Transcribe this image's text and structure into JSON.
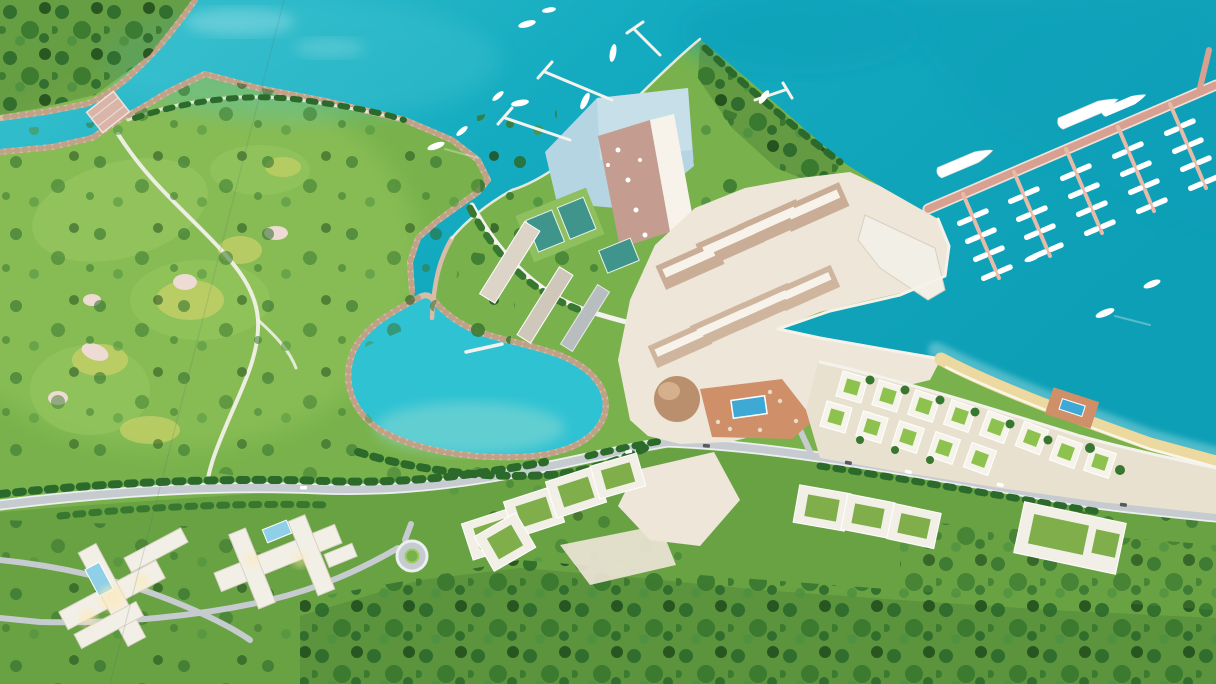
{
  "meta": {
    "title": "Aerial 3D master-plan rendering of a coastal golf and marina resort",
    "view": "bird's-eye aerial render, no text or UI elements visible"
  },
  "palette": {
    "sea_base": "#17b1c5",
    "sea_deep": "#0a9fb8",
    "sea_light": "#49c7d3",
    "sea_pale": "#cdeff0",
    "lagoon": "#2fc2d3",
    "lagoon_shallow": "#93dbd2",
    "grass": "#79b24c",
    "lawn": "#69a243",
    "grass_light": "#93c45c",
    "golf_yellow": "#c2cf66",
    "bunker": "#eedbd3",
    "forest_base": "#54893a",
    "tree_dark": "#2c6a2c",
    "tree_mid": "#38772f",
    "tree_deep": "#224f1e",
    "tree_light": "#4f9140",
    "rock": "#d7bda8",
    "rock_dark": "#b69478",
    "sand": "#ecd9a0",
    "road": "#c6cbd0",
    "road_edge": "#eceff0",
    "path_white": "#f4f2ec",
    "plaza": "#eee6d8",
    "tan_wall": "#c9ad96",
    "tan_wall2": "#cfb59e",
    "roof_white": "#f7f3ea",
    "white": "#ffffff",
    "terracotta": "#cf9069",
    "dome": "#ba8f6e",
    "dome_light": "#d8b792",
    "pool_blue": "#3fa9d5",
    "pool_pale": "#b6d5e2",
    "pool_sheen": "#cde3ec",
    "tennis": "#3f948c",
    "court_green": "#8fbf5f",
    "villa_green": "#8ec24e",
    "villa_wall": "#f6f3ea",
    "glow": "#ffe9b2",
    "hotel_white": "#f2efe7",
    "hotel_shadow": "#d9d2c4",
    "bridge": "#d8b5a8",
    "cable": "#5a6a6a"
  },
  "scene": {
    "sea": {
      "label": "Turquoise sea and bay"
    },
    "golf_course": {
      "label": "Golf course headland with fairways, bunkers and winding cart path"
    },
    "channel": {
      "label": "Rock-lined sea channel crossed by a small bridge"
    },
    "lagoon": {
      "label": "Rock-rimmed inland lagoon with jetty"
    },
    "peninsula": {
      "label": "Resort peninsula with infinity pool, tower and tennis courts"
    },
    "village": {
      "label": "Marina village with tan shop rows, dome pavilion and terracotta pool deck"
    },
    "marina": {
      "label": "Marina with long main pier, finger docks and berthed boats",
      "finger_piers": 5
    },
    "beach": {
      "label": "Curving sandy beach"
    },
    "beach_villas": {
      "label": "Beachfront villa grid with green courtyards and beach club pool"
    },
    "south_villas": {
      "label": "Green-roofed villa blocks along the coastal road"
    },
    "hotels": {
      "label": "Two hillside hotel complexes with pools and lit courtyards"
    },
    "roads": {
      "label": "Coastal road with roundabout and winding hillside lanes"
    },
    "forest": {
      "label": "Wooded parkland covering the southern hills"
    }
  }
}
